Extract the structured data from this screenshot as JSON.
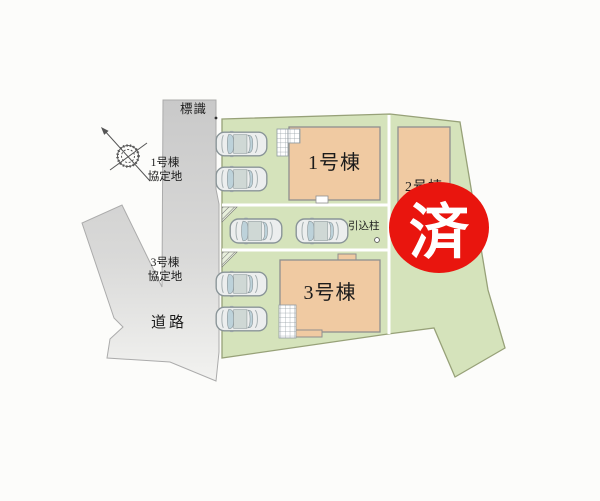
{
  "site_plan": {
    "sign_label": "標識",
    "agreement_area_1": "1号棟\n協定地",
    "agreement_area_3": "3号棟\n協定地",
    "road_label": "道路",
    "buildings": [
      {
        "name": "1号棟"
      },
      {
        "name": "2号棟"
      },
      {
        "name": "3号棟"
      }
    ],
    "utility_pole_label": "引込柱",
    "sold_stamp": "済",
    "car_count": 6
  },
  "colors": {
    "plot_green": "#d5e3bb",
    "plot_border": "#97a178",
    "building_tan": "#f0caa2",
    "building_border": "#8f8f8f",
    "road_top": "#c9c9c9",
    "road_bottom": "#f3f3f1",
    "stamp_red": "#e9150e",
    "stamp_text": "#ffffff",
    "ink": "#1b1b1b"
  }
}
